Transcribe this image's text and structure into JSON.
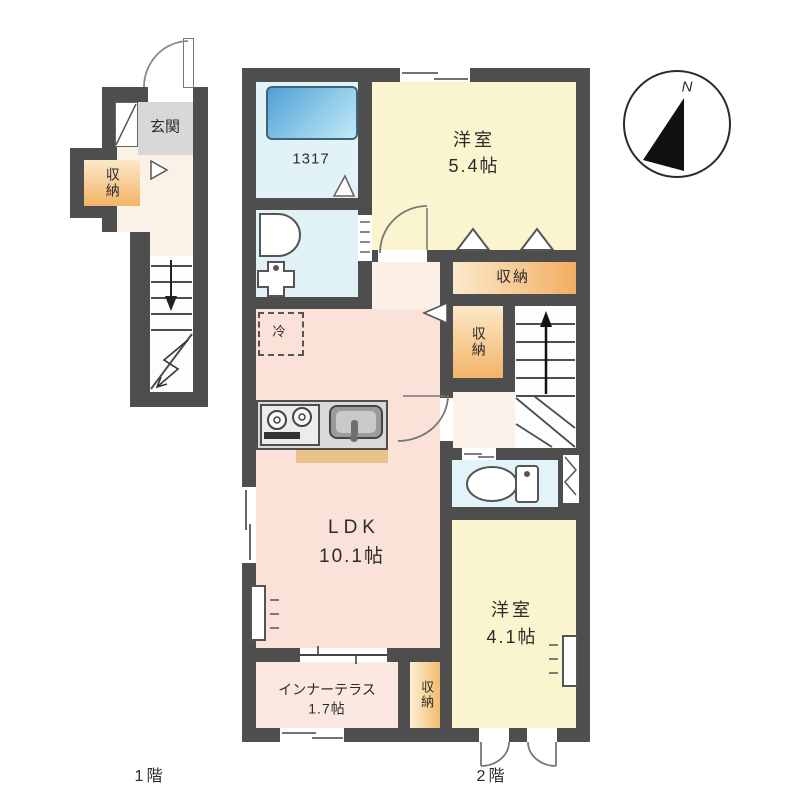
{
  "page": {
    "background": "#ffffff"
  },
  "compass": {
    "north_label": "N"
  },
  "floor1": {
    "caption": "1階",
    "entrance_label": "玄関",
    "storage_label": "収納"
  },
  "floor2": {
    "caption": "2階",
    "unit_bath_label": "1317",
    "bedroom_a_name": "洋室",
    "bedroom_a_size": "5.4帖",
    "closet_a_label": "収納",
    "closet_b_label": "収納",
    "refrigerator_label": "冷",
    "ldk_name": "LDK",
    "ldk_size": "10.1帖",
    "bedroom_b_name": "洋室",
    "bedroom_b_size": "4.1帖",
    "terrace_name": "インナーテラス",
    "terrace_size": "1.7帖",
    "closet_c_label": "収納"
  },
  "colors": {
    "wall": "#4e4e4e",
    "bedroom_yellow": "#faf4cf",
    "ldk_pink": "#fbe2d8",
    "terrace_pink": "#fae8e1",
    "wet_area_cyan": "#e1f3f7",
    "storage_orange": "#f2b267",
    "bathtub_blue": "#5ca6d8",
    "entrance_gray": "#d8d8d8"
  }
}
